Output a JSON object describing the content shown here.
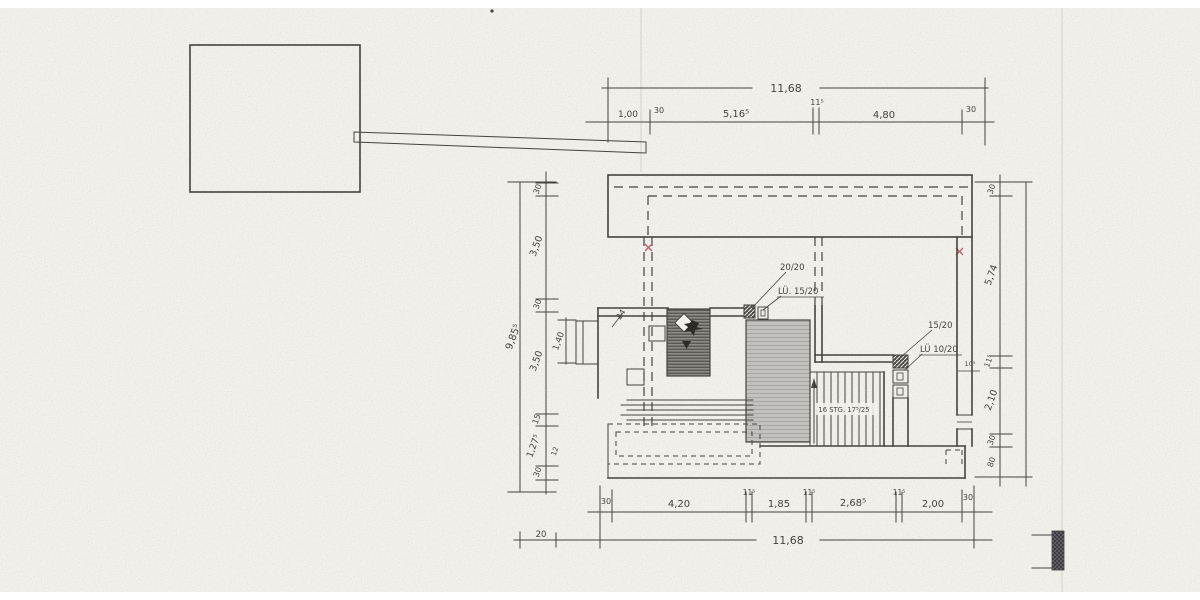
{
  "colors": {
    "ink": "#45433d",
    "red_mark": "#c2606a",
    "paper": "#f2f1ec",
    "chimney_gray": "#8e8c88",
    "void_gray": "#c2c1bd",
    "hatch_dark": "#3f3d45"
  },
  "top_dims": {
    "overall": "11,68",
    "seg_100": "1,00",
    "seg_30a": "30",
    "seg_516": "5,16⁵",
    "seg_115": "11⁵",
    "seg_480": "4,80",
    "seg_30b": "30"
  },
  "left_dims": {
    "overall": "9,85⁵",
    "seg_30a": "30",
    "seg_350a": "3,50",
    "seg_30b": "30",
    "seg_350b": "3,50",
    "seg_15": "15",
    "seg_1275": "1,27⁵",
    "seg_30c": "30",
    "inner_140": "1,40",
    "step_12": "12"
  },
  "right_dims": {
    "seg_30a": "30",
    "seg_574": "5,74",
    "seg_115": "11⁵",
    "seg_210": "2,10",
    "seg_30b": "30",
    "seg_80": "80",
    "seg_10": "10⁵"
  },
  "bottom_dims": {
    "overall": "11,68",
    "lead_20": "20",
    "seg_30a": "30",
    "seg_420": "4,20",
    "seg_115a": "11⁵",
    "seg_185": "1,85",
    "seg_115m": "11⁵",
    "seg_2685": "2,68⁵",
    "seg_115b": "11⁵",
    "seg_200": "2,00",
    "seg_30b": "30"
  },
  "annotations": {
    "col_2020": "20/20",
    "vent_1520": "LÜ. 15/20",
    "col_1520": "15/20",
    "vent_1020": "LÜ 10/20",
    "stair_note": "16 STG. 17⁵/25",
    "wall_24": "24"
  }
}
